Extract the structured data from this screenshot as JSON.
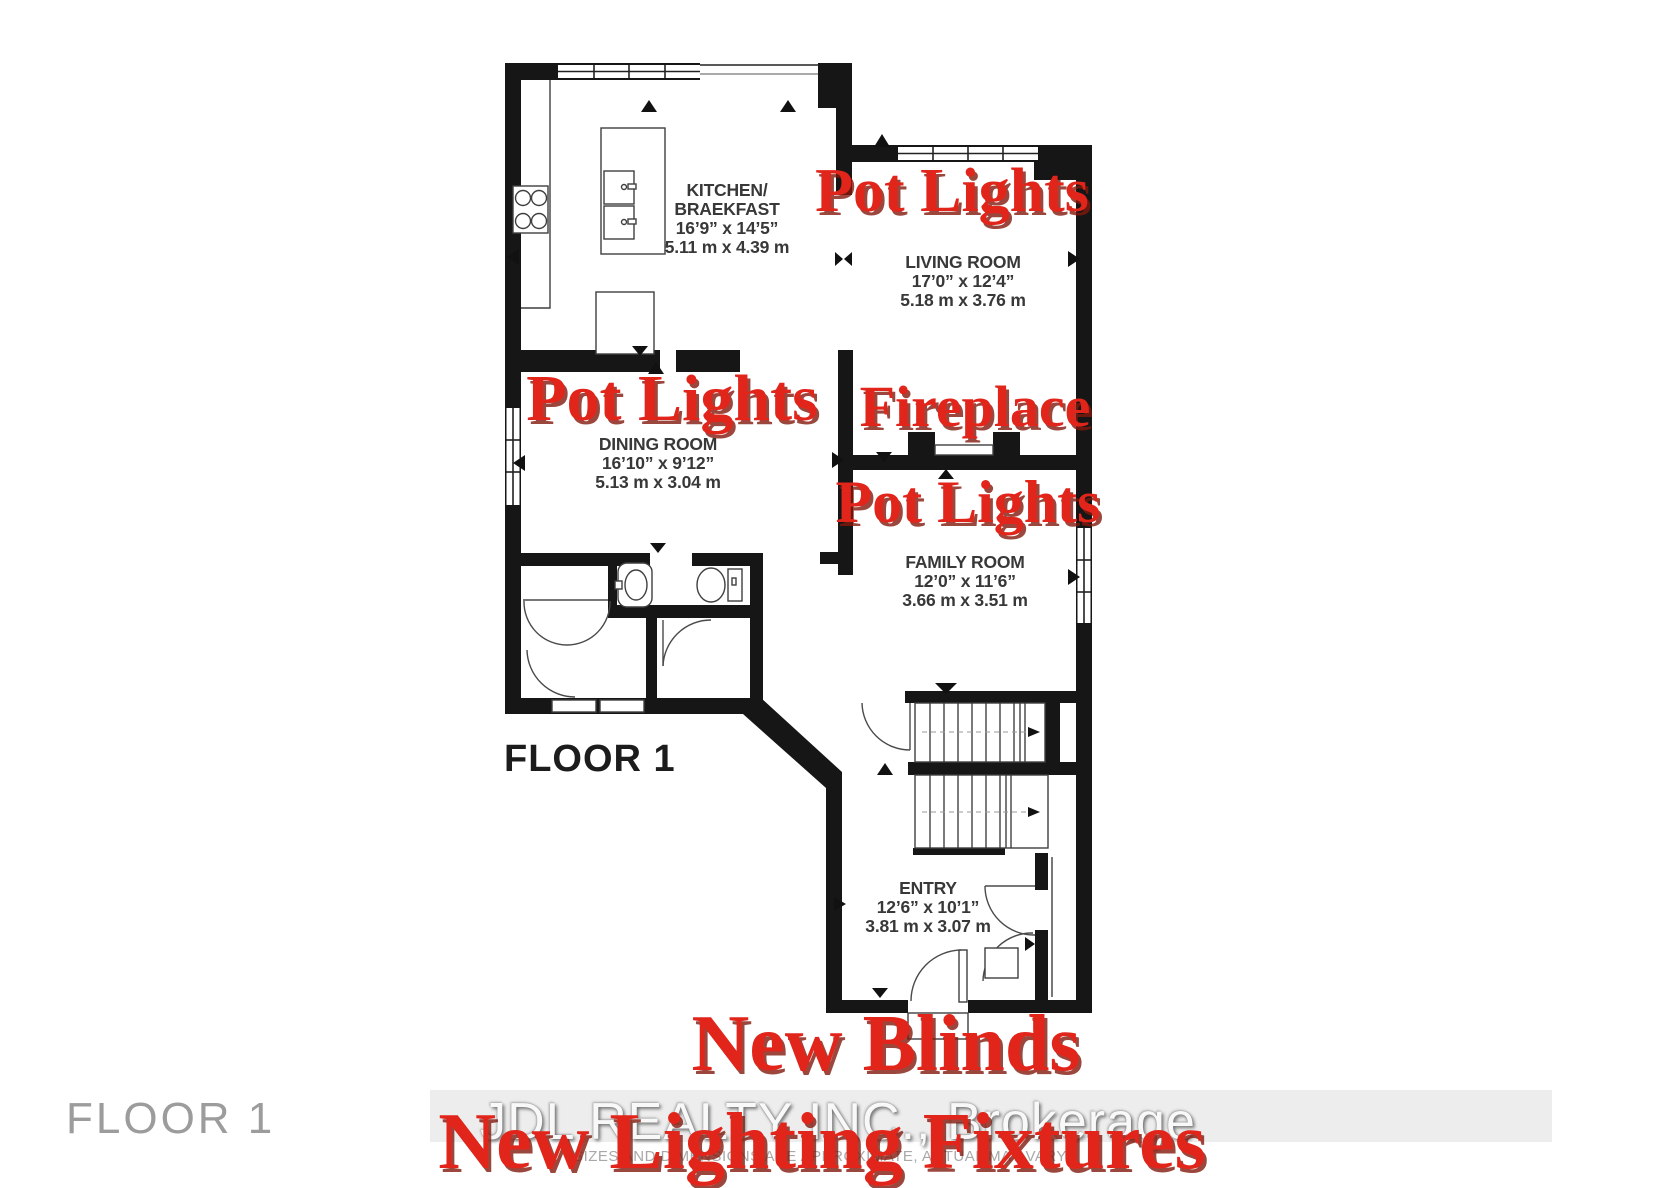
{
  "annotations": {
    "pot_lights_living": "Pot Lights",
    "pot_lights_dining": "Pot Lights",
    "pot_lights_family": "Pot Lights",
    "fireplace": "Fireplace",
    "new_blinds": "New Blinds",
    "new_lighting_fixtures": "New Lighting Fixtures",
    "text_color": "#e2251b"
  },
  "rooms": {
    "kitchen": {
      "name_line1": "KITCHEN/",
      "name_line2": "BRAEKFAST",
      "imperial": "16’9” x 14’5”",
      "metric": "5.11 m x 4.39 m"
    },
    "living": {
      "name": "LIVING ROOM",
      "imperial": "17’0” x 12’4”",
      "metric": "5.18 m x 3.76 m"
    },
    "dining": {
      "name": "DINING ROOM",
      "imperial": "16’10” x 9’12”",
      "metric": "5.13 m x 3.04 m"
    },
    "family": {
      "name": "FAMILY ROOM",
      "imperial": "12’0” x 11’6”",
      "metric": "3.66 m x 3.51 m"
    },
    "entry": {
      "name": "ENTRY",
      "imperial": "12’6” x 10’1”",
      "metric": "3.81 m x 3.07 m"
    }
  },
  "labels": {
    "floor_plan": "FLOOR 1",
    "floor_corner": "FLOOR 1"
  },
  "watermark": "JDL REALTY INC.,  Brokerage",
  "disclaimer": "SIZES AND DIMENSIONS ARE APPROXIMATE, ACTUAL MAY VARY",
  "colors": {
    "wall": "#161616",
    "annotation_red": "#e2251b",
    "floor_corner_gray": "#9c9c9c"
  }
}
